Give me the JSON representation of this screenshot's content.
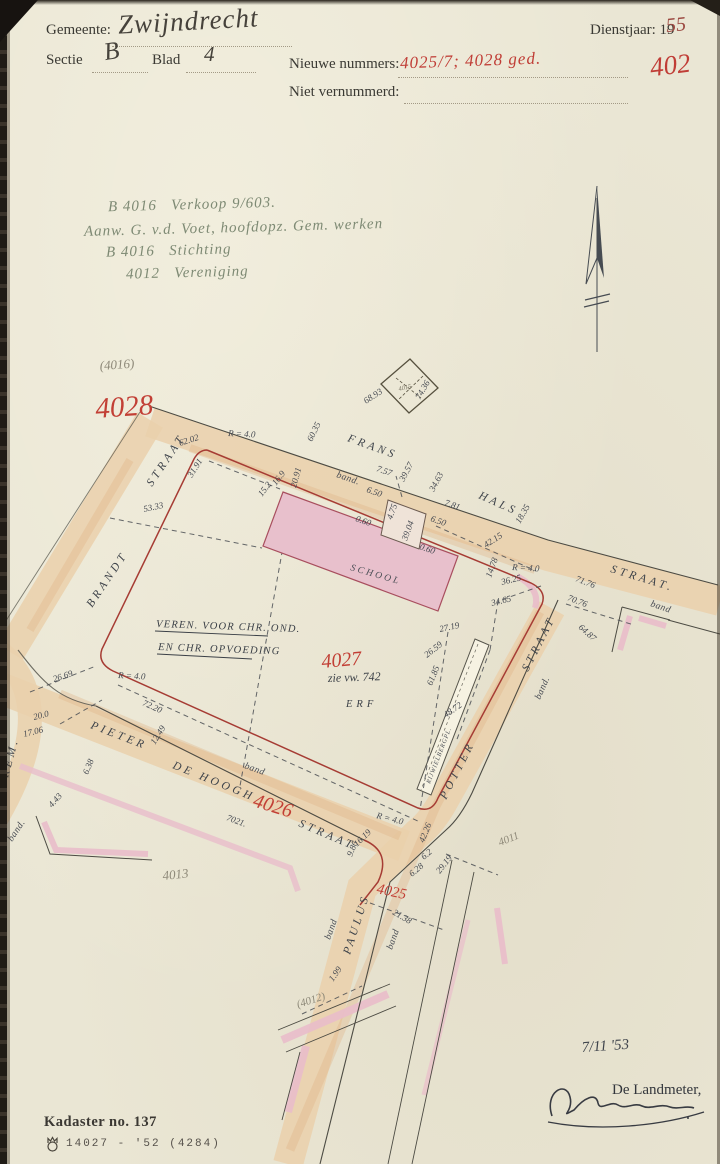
{
  "header": {
    "gemeente_label": "Gemeente:",
    "gemeente_value": "Zwijndrecht",
    "sectie_label": "Sectie",
    "sectie_value": "B",
    "blad_label": "Blad",
    "blad_value": "4",
    "dienstjaar_label": "Dienstjaar: 19",
    "dienstjaar_value": "55",
    "nieuwe_nummers_label": "Nieuwe nummers:",
    "nieuwe_nummers_value": "4025/7; 4028 ged.",
    "niet_vernummerd_label": "Niet vernummerd:",
    "sheet_number": "402"
  },
  "notes": {
    "lines": [
      "B 4016   Verkoop 9/603.",
      "Aanw. G. v.d. Voet, hoofdopz. Gem. werken",
      "B 4016   Stichting",
      "4012   Vereniging"
    ]
  },
  "map": {
    "labels": [
      {
        "t": "FRANS",
        "x": 347,
        "y": 441,
        "r": 20,
        "c": "street",
        "n": "street-name-frans"
      },
      {
        "t": "HALS",
        "x": 478,
        "y": 498,
        "r": 24,
        "c": "street",
        "n": "street-name-hals"
      },
      {
        "t": "STRAAT.",
        "x": 610,
        "y": 572,
        "r": 17,
        "c": "street",
        "n": "street-name-straat-east"
      },
      {
        "t": "STRAAT",
        "x": 152,
        "y": 487,
        "r": -56,
        "c": "street",
        "n": "street-name-brandt-straat"
      },
      {
        "t": "BRANDT",
        "x": 92,
        "y": 608,
        "r": -56,
        "c": "street",
        "n": "street-name-brandt"
      },
      {
        "t": "STRAAT",
        "x": 528,
        "y": 672,
        "r": -63,
        "c": "street",
        "n": "street-name-potter-straat"
      },
      {
        "t": "POTTER",
        "x": 446,
        "y": 800,
        "r": -63,
        "c": "street",
        "n": "street-name-potter"
      },
      {
        "t": "PAULUS",
        "x": 350,
        "y": 955,
        "r": -72,
        "c": "street",
        "n": "street-name-paulus"
      },
      {
        "t": "PIETER",
        "x": 90,
        "y": 728,
        "r": 21,
        "c": "street",
        "n": "street-name-pieter"
      },
      {
        "t": "DE HOOGH",
        "x": 172,
        "y": 768,
        "r": 22,
        "c": "street",
        "n": "street-name-de-hoogh"
      },
      {
        "t": "STRAAT",
        "x": 298,
        "y": 826,
        "r": 23,
        "c": "street",
        "n": "street-name-de-hoogh-straat"
      },
      {
        "t": "REM.",
        "x": 8,
        "y": 778,
        "r": -75,
        "c": "street",
        "n": "street-name-rem"
      },
      {
        "t": "4028",
        "x": 96,
        "y": 418,
        "r": -4,
        "c": "red-lg",
        "n": "parcel-number-4028"
      },
      {
        "t": "4027",
        "x": 322,
        "y": 668,
        "r": -5,
        "c": "red-md",
        "n": "parcel-number-4027"
      },
      {
        "t": "4026",
        "x": 252,
        "y": 806,
        "r": 17,
        "c": "red-md",
        "n": "parcel-number-4026"
      },
      {
        "t": "4025",
        "x": 376,
        "y": 893,
        "r": 12,
        "c": "red-sm",
        "n": "parcel-number-4025"
      },
      {
        "t": "(4016)",
        "x": 100,
        "y": 370,
        "r": -4,
        "c": "pencil",
        "n": "parcel-number-4016"
      },
      {
        "t": "4015",
        "x": 399,
        "y": 391,
        "r": -13,
        "c": "pencil-xs",
        "n": "parcel-number-4015"
      },
      {
        "t": "4013",
        "x": 163,
        "y": 880,
        "r": -6,
        "c": "pencil",
        "n": "parcel-number-4013"
      },
      {
        "t": "4011",
        "x": 500,
        "y": 846,
        "r": -22,
        "c": "pencil-sm",
        "n": "parcel-number-4011"
      },
      {
        "t": "(4012)",
        "x": 298,
        "y": 1008,
        "r": -18,
        "c": "pencil-sm",
        "n": "parcel-number-4012"
      },
      {
        "t": "VEREN. VOOR CHR. OND.",
        "x": 156,
        "y": 627,
        "r": 2,
        "c": "ink",
        "n": "owner-annotation-line1"
      },
      {
        "t": "EN CHR. OPVOEDING",
        "x": 158,
        "y": 650,
        "r": 2,
        "c": "ink",
        "n": "owner-annotation-line2"
      },
      {
        "t": "zie vw. 742",
        "x": 328,
        "y": 682,
        "r": -2,
        "c": "ink2",
        "n": "reference-annotation"
      },
      {
        "t": "ERF",
        "x": 346,
        "y": 707,
        "r": 0,
        "c": "inkls",
        "n": "erf-label"
      },
      {
        "t": "SCHOOL",
        "x": 350,
        "y": 570,
        "r": 16,
        "c": "schooltxt",
        "n": "school-label"
      },
      {
        "t": "RIJWIELBERGPL.",
        "x": 430,
        "y": 784,
        "r": -69,
        "c": "strip",
        "n": "bicycle-shed-label"
      },
      {
        "t": "7021.",
        "x": 226,
        "y": 820,
        "r": 20,
        "c": "meas",
        "n": "road-parcel-number"
      },
      {
        "t": "68.93",
        "x": 366,
        "y": 404,
        "r": -33,
        "c": "meas",
        "n": "measurement-label"
      },
      {
        "t": "74.36",
        "x": 420,
        "y": 400,
        "r": -60,
        "c": "meas",
        "n": "measurement-label"
      },
      {
        "t": "60.35",
        "x": 312,
        "y": 442,
        "r": -64,
        "c": "meas",
        "n": "measurement-label"
      },
      {
        "t": "62.02",
        "x": 180,
        "y": 446,
        "r": -18,
        "c": "meas",
        "n": "measurement-label"
      },
      {
        "t": "31.91",
        "x": 192,
        "y": 478,
        "r": -58,
        "c": "meas",
        "n": "measurement-label"
      },
      {
        "t": "53.33",
        "x": 144,
        "y": 512,
        "r": -12,
        "c": "meas",
        "n": "measurement-label"
      },
      {
        "t": "R = 4.0",
        "x": 228,
        "y": 436,
        "r": 3,
        "c": "meas",
        "n": "radius-label"
      },
      {
        "t": "16.9",
        "x": 276,
        "y": 486,
        "r": -52,
        "c": "meas",
        "n": "measurement-label"
      },
      {
        "t": "15.2",
        "x": 262,
        "y": 497,
        "r": -52,
        "c": "meas",
        "n": "measurement-label"
      },
      {
        "t": "20.91",
        "x": 296,
        "y": 488,
        "r": -75,
        "c": "meas",
        "n": "measurement-label"
      },
      {
        "t": "band.",
        "x": 336,
        "y": 477,
        "r": 19,
        "c": "curs",
        "n": "band-label"
      },
      {
        "t": "6.50",
        "x": 366,
        "y": 492,
        "r": 19,
        "c": "meas",
        "n": "measurement-label"
      },
      {
        "t": "7.57",
        "x": 376,
        "y": 471,
        "r": 19,
        "c": "meas",
        "n": "measurement-label"
      },
      {
        "t": "39.57",
        "x": 404,
        "y": 482,
        "r": -62,
        "c": "meas",
        "n": "measurement-label"
      },
      {
        "t": "34.63",
        "x": 434,
        "y": 492,
        "r": -62,
        "c": "meas",
        "n": "measurement-label"
      },
      {
        "t": "7.81",
        "x": 444,
        "y": 505,
        "r": 19,
        "c": "meas",
        "n": "measurement-label"
      },
      {
        "t": "6.50",
        "x": 430,
        "y": 521,
        "r": 19,
        "c": "meas",
        "n": "measurement-label"
      },
      {
        "t": "0.60",
        "x": 355,
        "y": 521,
        "r": 19,
        "c": "meas",
        "n": "measurement-label"
      },
      {
        "t": "0.60",
        "x": 419,
        "y": 549,
        "r": 19,
        "c": "meas",
        "n": "measurement-label"
      },
      {
        "t": "4.75",
        "x": 392,
        "y": 520,
        "r": -70,
        "c": "meas",
        "n": "measurement-label"
      },
      {
        "t": "39.04",
        "x": 407,
        "y": 541,
        "r": -70,
        "c": "meas",
        "n": "measurement-label"
      },
      {
        "t": "42.15",
        "x": 486,
        "y": 548,
        "r": -33,
        "c": "meas",
        "n": "measurement-label"
      },
      {
        "t": "18.35",
        "x": 520,
        "y": 524,
        "r": -60,
        "c": "meas",
        "n": "measurement-label"
      },
      {
        "t": "14.78",
        "x": 491,
        "y": 578,
        "r": -70,
        "c": "meas",
        "n": "measurement-label"
      },
      {
        "t": "R = 4.0",
        "x": 512,
        "y": 570,
        "r": 3,
        "c": "meas",
        "n": "radius-label"
      },
      {
        "t": "36.25",
        "x": 502,
        "y": 585,
        "r": -14,
        "c": "meas",
        "n": "measurement-label"
      },
      {
        "t": "34.65",
        "x": 492,
        "y": 606,
        "r": -14,
        "c": "meas",
        "n": "measurement-label"
      },
      {
        "t": "27.19",
        "x": 440,
        "y": 632,
        "r": -12,
        "c": "meas",
        "n": "measurement-label"
      },
      {
        "t": "26.59",
        "x": 427,
        "y": 658,
        "r": -38,
        "c": "meas",
        "n": "measurement-label"
      },
      {
        "t": "61.85",
        "x": 432,
        "y": 686,
        "r": -68,
        "c": "meas",
        "n": "measurement-label"
      },
      {
        "t": "71.76",
        "x": 575,
        "y": 581,
        "r": 21,
        "c": "meas",
        "n": "measurement-label"
      },
      {
        "t": "70.76",
        "x": 567,
        "y": 600,
        "r": 21,
        "c": "meas",
        "n": "measurement-label"
      },
      {
        "t": "64.87",
        "x": 578,
        "y": 628,
        "r": 42,
        "c": "meas",
        "n": "measurement-label"
      },
      {
        "t": "band",
        "x": 650,
        "y": 606,
        "r": 19,
        "c": "curs",
        "n": "band-label"
      },
      {
        "t": "band.",
        "x": 540,
        "y": 700,
        "r": -66,
        "c": "curs",
        "n": "band-label"
      },
      {
        "t": "48.72",
        "x": 446,
        "y": 718,
        "r": -35,
        "c": "meas",
        "n": "measurement-label"
      },
      {
        "t": "26.69",
        "x": 54,
        "y": 682,
        "r": -18,
        "c": "meas",
        "n": "measurement-label"
      },
      {
        "t": "R = 4.0",
        "x": 118,
        "y": 678,
        "r": 3,
        "c": "meas",
        "n": "radius-label"
      },
      {
        "t": "72.20",
        "x": 142,
        "y": 705,
        "r": 24,
        "c": "meas",
        "n": "measurement-label"
      },
      {
        "t": "12.49",
        "x": 155,
        "y": 745,
        "r": -58,
        "c": "meas",
        "n": "measurement-label"
      },
      {
        "t": "20.0",
        "x": 34,
        "y": 720,
        "r": -14,
        "c": "meas",
        "n": "measurement-label"
      },
      {
        "t": "17.06",
        "x": 24,
        "y": 737,
        "r": -14,
        "c": "meas",
        "n": "measurement-label"
      },
      {
        "t": "band.",
        "x": 12,
        "y": 842,
        "r": -56,
        "c": "curs",
        "n": "band-label"
      },
      {
        "t": "4.43",
        "x": 52,
        "y": 808,
        "r": -48,
        "c": "meas",
        "n": "measurement-label"
      },
      {
        "t": "6.38",
        "x": 88,
        "y": 775,
        "r": -68,
        "c": "meas",
        "n": "measurement-label"
      },
      {
        "t": "band",
        "x": 244,
        "y": 768,
        "r": 20,
        "c": "curs",
        "n": "band-label"
      },
      {
        "t": "R = 4.0",
        "x": 376,
        "y": 818,
        "r": 14,
        "c": "meas",
        "n": "radius-label"
      },
      {
        "t": "42.26",
        "x": 424,
        "y": 843,
        "r": -68,
        "c": "meas",
        "n": "measurement-label"
      },
      {
        "t": "16.19",
        "x": 357,
        "y": 847,
        "r": -44,
        "c": "meas",
        "n": "measurement-label"
      },
      {
        "t": "9.86",
        "x": 352,
        "y": 857,
        "r": -68,
        "c": "meas",
        "n": "measurement-label"
      },
      {
        "t": "6.2",
        "x": 424,
        "y": 860,
        "r": -40,
        "c": "meas",
        "n": "measurement-label"
      },
      {
        "t": "6.28",
        "x": 412,
        "y": 877,
        "r": -40,
        "c": "meas",
        "n": "measurement-label"
      },
      {
        "t": "29.19",
        "x": 440,
        "y": 874,
        "r": -52,
        "c": "meas",
        "n": "measurement-label"
      },
      {
        "t": "band",
        "x": 330,
        "y": 940,
        "r": -70,
        "c": "curs",
        "n": "band-label"
      },
      {
        "t": "band",
        "x": 392,
        "y": 950,
        "r": -70,
        "c": "curs",
        "n": "band-label"
      },
      {
        "t": "21.38",
        "x": 392,
        "y": 914,
        "r": 30,
        "c": "meas",
        "n": "measurement-label"
      },
      {
        "t": "1.99",
        "x": 333,
        "y": 982,
        "r": -55,
        "c": "meas",
        "n": "measurement-label"
      },
      {
        "t": "7/11  '53",
        "x": 582,
        "y": 1052,
        "r": -4,
        "c": "date",
        "n": "survey-date"
      }
    ]
  },
  "signature": {
    "landmeter_label": "De Landmeter,"
  },
  "footer": {
    "kadaster_label": "Kadaster no. 137",
    "print_code": "14027 - '52 (4284)"
  },
  "colors": {
    "paper": "#eae6d4",
    "street_fill": "#ead0ab",
    "parcel_line_red": "#a63c34",
    "red_ink": "#c03d36",
    "pencil_gray": "#8d8878",
    "green_note": "#7e8a74",
    "black_ink": "#3f444b",
    "school_fill": "#e8c0cc",
    "pink_hatch": "#e9bdca"
  }
}
